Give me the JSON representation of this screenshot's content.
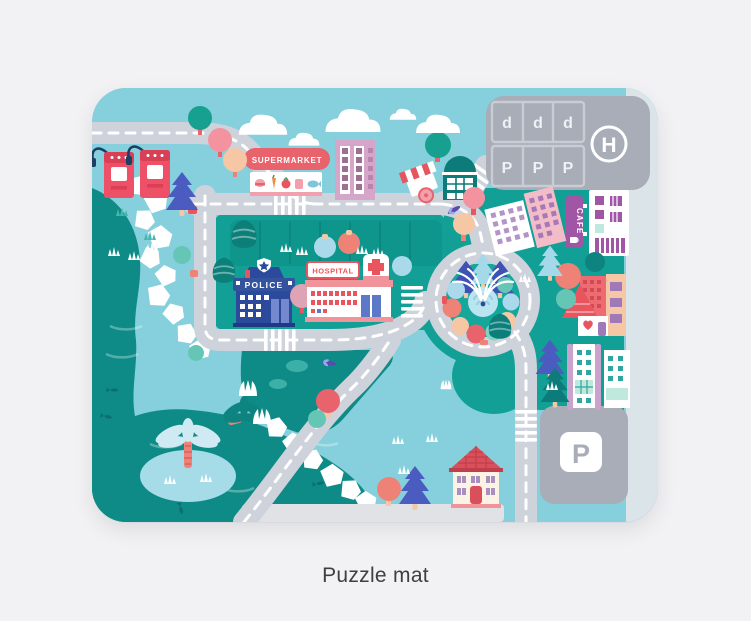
{
  "caption": "Puzzle mat",
  "mat": {
    "labels": {
      "supermarket": "SUPERMARKET",
      "police": "POLICE",
      "hospital": "HOSPITAL",
      "cafe": "CAFE",
      "helipad": "H",
      "parking_sign": "P"
    },
    "rooftop_lot": {
      "row_top": [
        "d",
        "d",
        "d"
      ],
      "row_bottom": [
        "P",
        "P",
        "P"
      ]
    },
    "palette": {
      "page_bg": "#f2f1f3",
      "mat_sky": "#85d0dc",
      "land_teal": "#12a096",
      "lake_teal": "#0e8b87",
      "road_gray": "#ced2da",
      "lot_gray": "#a8adb8",
      "sidewalk": "#e0e2e6",
      "sign_red": "#e8636b",
      "coral": "#ee8276",
      "pink": "#f2a0ad",
      "peach": "#f6c7a4",
      "mint": "#7fd4c2",
      "light_blue": "#a9d9ea",
      "indigo_pine": "#4a5cc0",
      "dark_pine": "#0d7b79",
      "police_blue": "#2b4a9b",
      "hospital_red": "#e8555e",
      "cafe_purple": "#a055a5",
      "white": "#ffffff"
    }
  }
}
